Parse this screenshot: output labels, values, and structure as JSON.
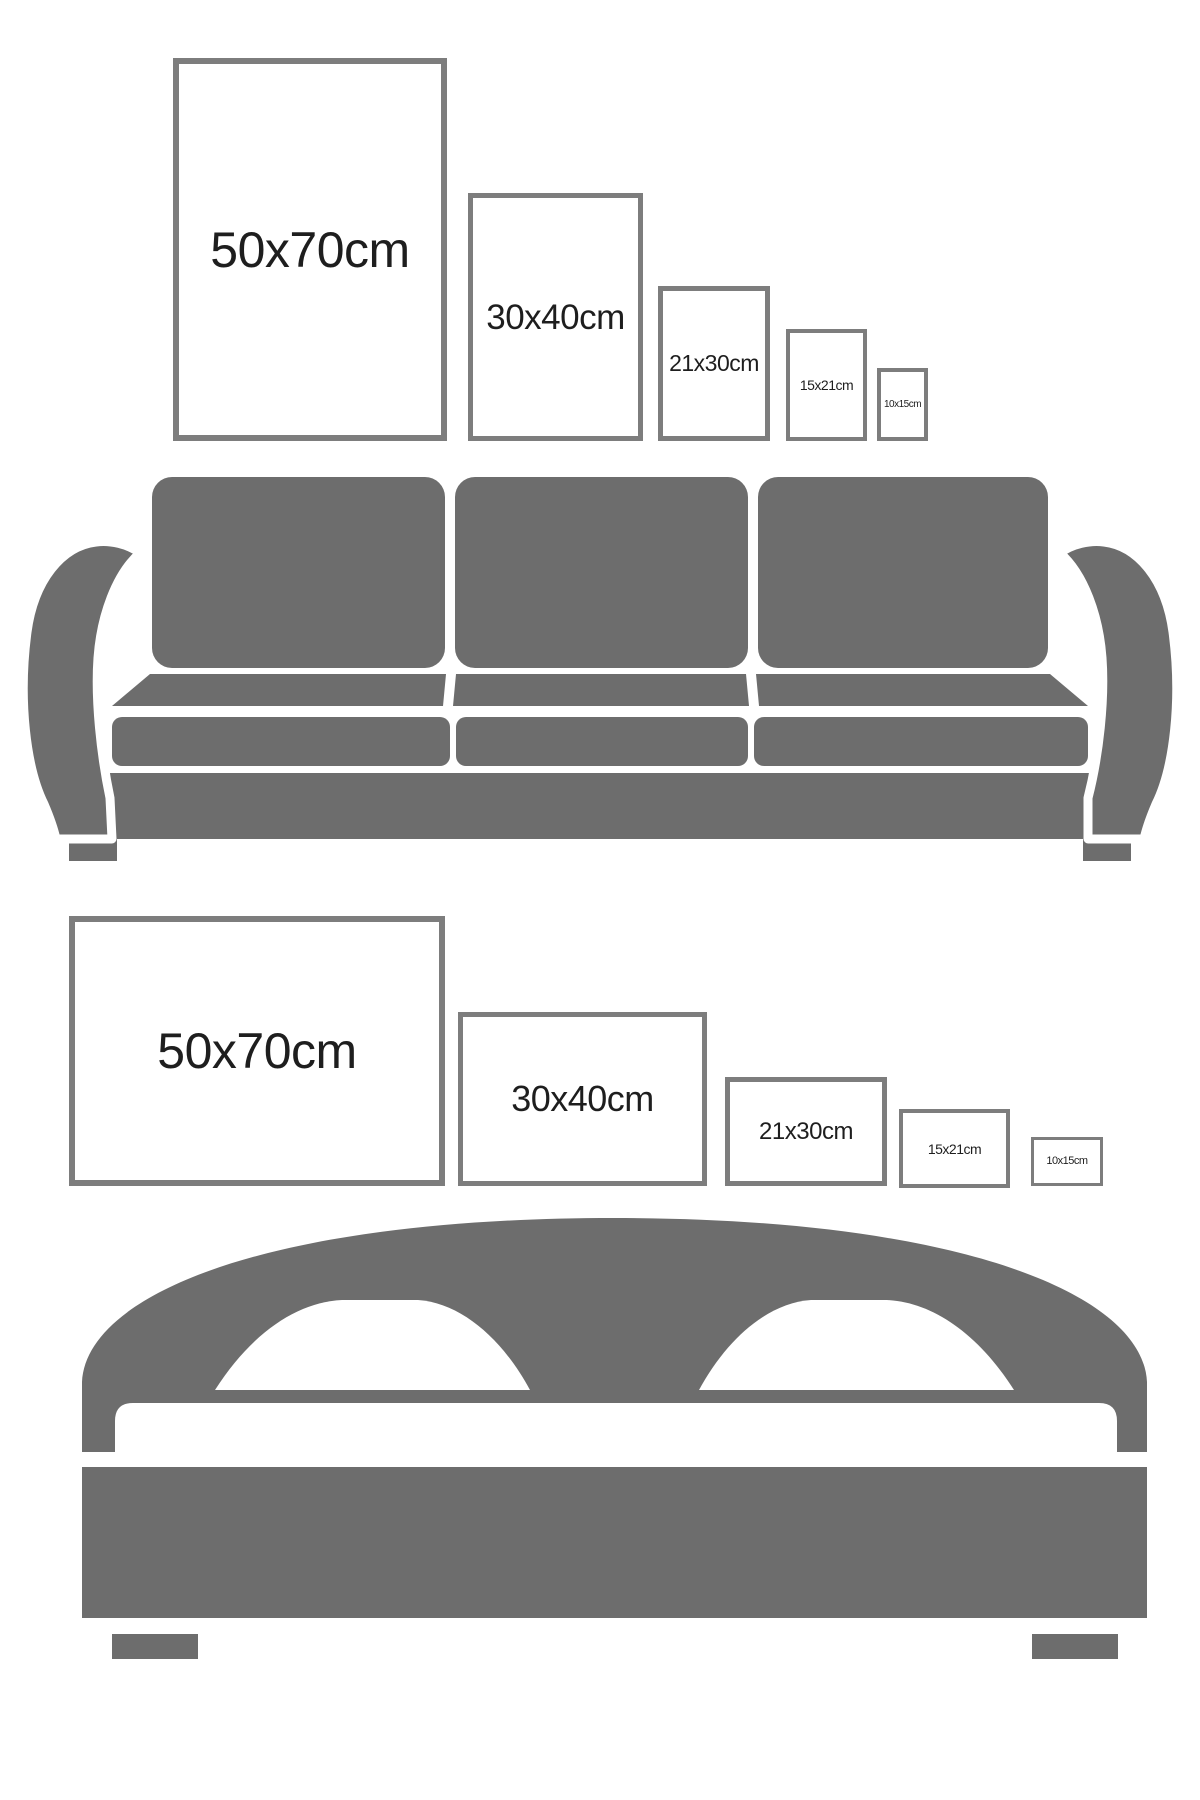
{
  "colors": {
    "background": "#ffffff",
    "silhouette_gray": "#6d6d6d",
    "frame_border_gray": "#7d7d7d",
    "label_text": "#1e1e1e"
  },
  "rows": {
    "portrait": {
      "frames": [
        {
          "label": "50x70cm"
        },
        {
          "label": "30x40cm"
        },
        {
          "label": "21x30cm"
        },
        {
          "label": "15x21cm"
        },
        {
          "label": "10x15cm"
        }
      ]
    },
    "landscape": {
      "frames": [
        {
          "label": "50x70cm"
        },
        {
          "label": "30x40cm"
        },
        {
          "label": "21x30cm"
        },
        {
          "label": "15x21cm"
        },
        {
          "label": "10x15cm"
        }
      ]
    }
  },
  "icons": {
    "sofa": "sofa-silhouette",
    "bed": "bed-silhouette"
  }
}
